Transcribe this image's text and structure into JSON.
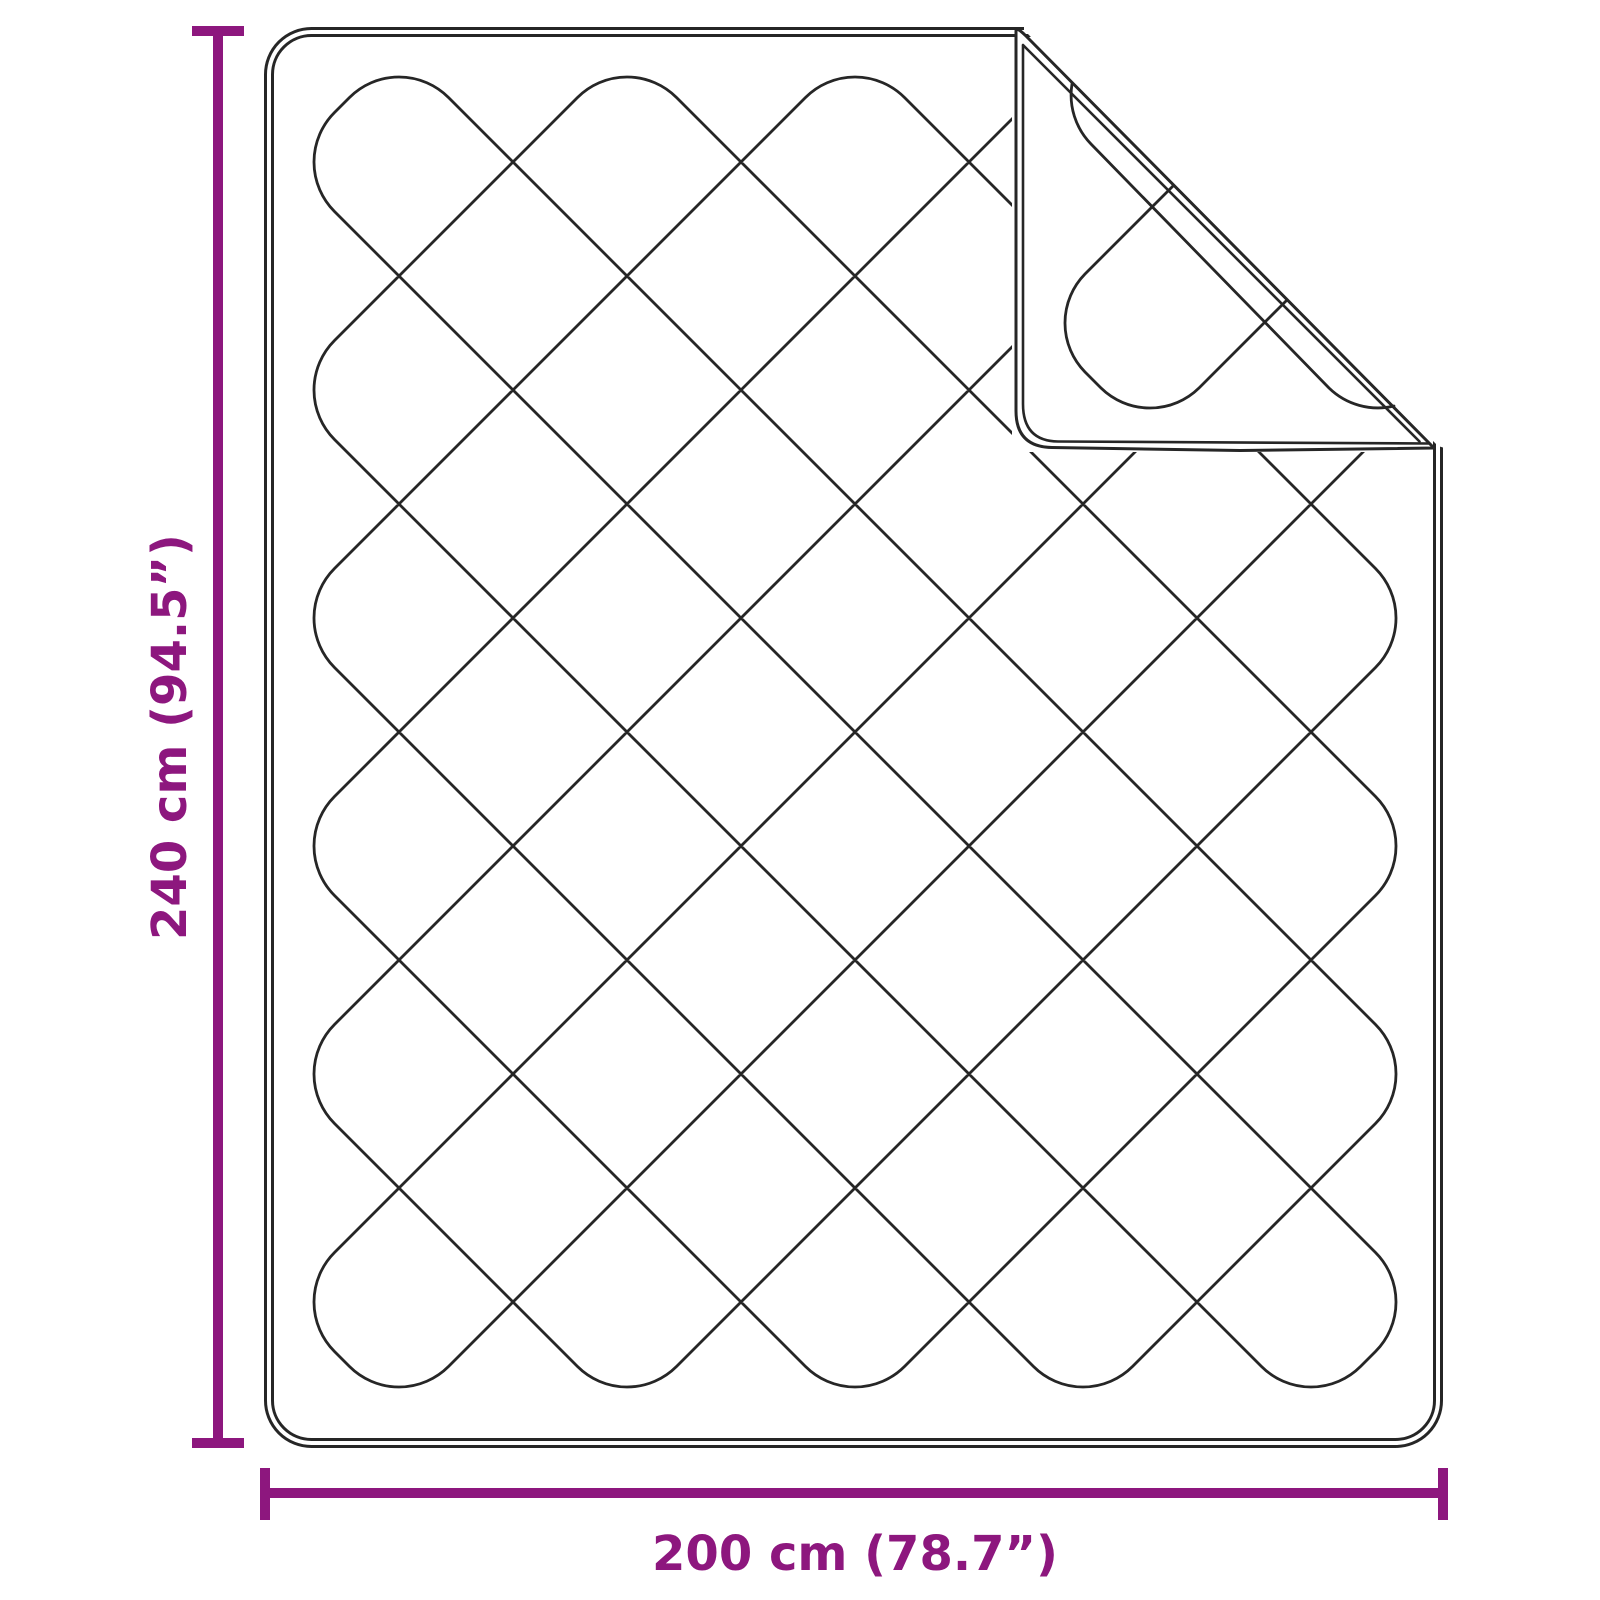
{
  "diagram": {
    "type": "product-dimension-diagram",
    "product": "quilted blanket with folded corner",
    "dimensions": {
      "height": {
        "label": "240 cm (94.5”)",
        "value_cm": 240,
        "value_inch": 94.5
      },
      "width": {
        "label": "200 cm (78.7”)",
        "value_cm": 200,
        "value_inch": 78.7
      }
    },
    "colors": {
      "accent": "#8D177E",
      "line": "#262626",
      "background": "#ffffff"
    }
  }
}
